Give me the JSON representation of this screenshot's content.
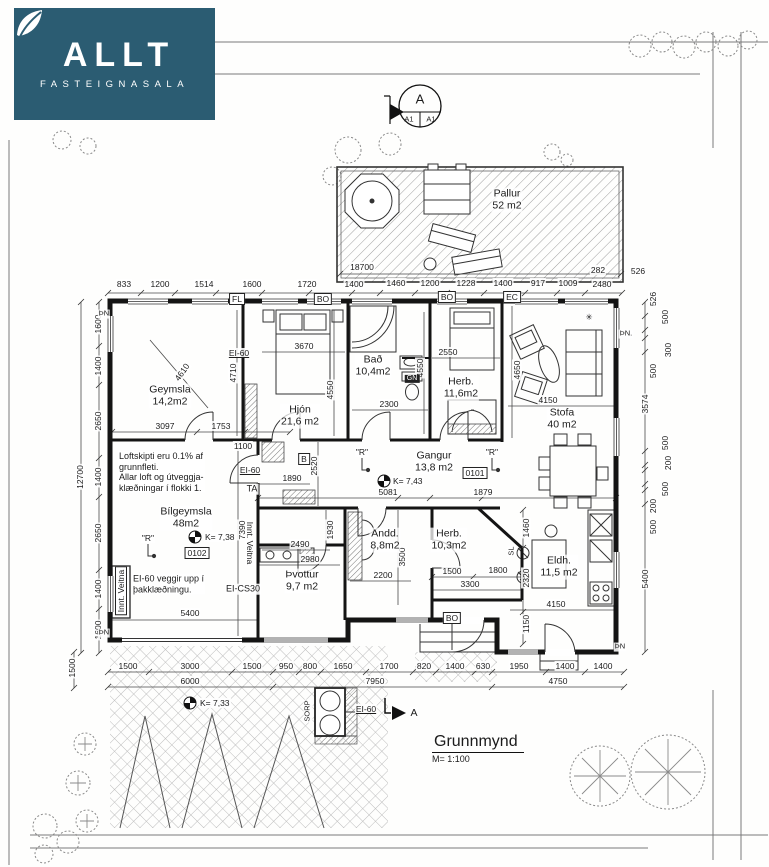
{
  "colors": {
    "logo_bg": "#2b5c72",
    "ink": "#1b1b1b"
  },
  "logo": {
    "brand": "ALLT",
    "subtitle": "FASTEIGNASALA"
  },
  "section_marker": {
    "letter": "A",
    "left": "A1",
    "right": "A1"
  },
  "title_block": {
    "title": "Grunnmynd",
    "scale": "M= 1:100"
  },
  "globes": [
    {
      "x": 384,
      "y": 481
    },
    {
      "x": 195,
      "y": 537
    },
    {
      "x": 190,
      "y": 703
    }
  ],
  "labels": [
    {
      "t": "833",
      "x": 124,
      "y": 284
    },
    {
      "t": "1200",
      "x": 160,
      "y": 284
    },
    {
      "t": "1514",
      "x": 204,
      "y": 284
    },
    {
      "t": "1600",
      "x": 252,
      "y": 284
    },
    {
      "t": "1720",
      "x": 307,
      "y": 284
    },
    {
      "t": "1400",
      "x": 354,
      "y": 284
    },
    {
      "t": "1460",
      "x": 396,
      "y": 283
    },
    {
      "t": "1200",
      "x": 430,
      "y": 283
    },
    {
      "t": "1228",
      "x": 466,
      "y": 283
    },
    {
      "t": "1400",
      "x": 503,
      "y": 283
    },
    {
      "t": "917",
      "x": 538,
      "y": 283
    },
    {
      "t": "1009",
      "x": 568,
      "y": 283
    },
    {
      "t": "282",
      "x": 598,
      "y": 270
    },
    {
      "t": "2480",
      "x": 602,
      "y": 284
    },
    {
      "t": "526",
      "x": 638,
      "y": 271
    },
    {
      "t": "18700",
      "x": 362,
      "y": 267
    },
    {
      "t": "1600",
      "x": 98,
      "y": 324,
      "r": -90
    },
    {
      "t": "1400",
      "x": 98,
      "y": 366,
      "r": -90
    },
    {
      "t": "2650",
      "x": 98,
      "y": 421,
      "r": -90
    },
    {
      "t": "1400",
      "x": 98,
      "y": 477,
      "r": -90
    },
    {
      "t": "2650",
      "x": 98,
      "y": 533,
      "r": -90
    },
    {
      "t": "1400",
      "x": 98,
      "y": 589,
      "r": -90
    },
    {
      "t": "1600",
      "x": 98,
      "y": 630,
      "r": -90
    },
    {
      "t": "12700",
      "x": 80,
      "y": 477,
      "r": -90
    },
    {
      "t": "1500",
      "x": 72,
      "y": 668,
      "r": -90
    },
    {
      "t": "526",
      "x": 653,
      "y": 299,
      "r": -90
    },
    {
      "t": "500",
      "x": 665,
      "y": 317,
      "r": -90
    },
    {
      "t": "300",
      "x": 668,
      "y": 350,
      "r": -90
    },
    {
      "t": "500",
      "x": 653,
      "y": 371,
      "r": -90
    },
    {
      "t": "3574",
      "x": 645,
      "y": 404,
      "r": -90
    },
    {
      "t": "500",
      "x": 665,
      "y": 443,
      "r": -90
    },
    {
      "t": "200",
      "x": 668,
      "y": 463,
      "r": -90
    },
    {
      "t": "500",
      "x": 665,
      "y": 489,
      "r": -90
    },
    {
      "t": "200",
      "x": 653,
      "y": 506,
      "r": -90
    },
    {
      "t": "500",
      "x": 653,
      "y": 527,
      "r": -90
    },
    {
      "t": "5400",
      "x": 645,
      "y": 579,
      "r": -90
    },
    {
      "t": "1500",
      "x": 128,
      "y": 666
    },
    {
      "t": "3000",
      "x": 190,
      "y": 666
    },
    {
      "t": "1500",
      "x": 252,
      "y": 666
    },
    {
      "t": "950",
      "x": 286,
      "y": 666
    },
    {
      "t": "800",
      "x": 310,
      "y": 666
    },
    {
      "t": "1650",
      "x": 343,
      "y": 666
    },
    {
      "t": "1700",
      "x": 389,
      "y": 666
    },
    {
      "t": "820",
      "x": 424,
      "y": 666
    },
    {
      "t": "1400",
      "x": 455,
      "y": 666
    },
    {
      "t": "630",
      "x": 483,
      "y": 666
    },
    {
      "t": "1950",
      "x": 519,
      "y": 666
    },
    {
      "t": "1400",
      "x": 565,
      "y": 666
    },
    {
      "t": "1400",
      "x": 603,
      "y": 666
    },
    {
      "t": "6000",
      "x": 190,
      "y": 681
    },
    {
      "t": "7950",
      "x": 375,
      "y": 681
    },
    {
      "t": "4750",
      "x": 558,
      "y": 681
    },
    {
      "t": "3097",
      "x": 165,
      "y": 426
    },
    {
      "t": "1753",
      "x": 221,
      "y": 426
    },
    {
      "t": "1100",
      "x": 243,
      "y": 446
    },
    {
      "t": "3670",
      "x": 304,
      "y": 346
    },
    {
      "t": "4710",
      "x": 233,
      "y": 373,
      "r": -90
    },
    {
      "t": "4550",
      "x": 330,
      "y": 390,
      "r": -90
    },
    {
      "t": "2550",
      "x": 448,
      "y": 352
    },
    {
      "t": "2300",
      "x": 389,
      "y": 404
    },
    {
      "t": "4550",
      "x": 420,
      "y": 368,
      "r": -90
    },
    {
      "t": "4650",
      "x": 517,
      "y": 370,
      "r": -90
    },
    {
      "t": "4150",
      "x": 548,
      "y": 400
    },
    {
      "t": "1890",
      "x": 292,
      "y": 478
    },
    {
      "t": "2520",
      "x": 314,
      "y": 466,
      "r": -90
    },
    {
      "t": "5081",
      "x": 388,
      "y": 492
    },
    {
      "t": "1879",
      "x": 483,
      "y": 492
    },
    {
      "t": "2490",
      "x": 300,
      "y": 544
    },
    {
      "t": "1930",
      "x": 330,
      "y": 530,
      "r": -90
    },
    {
      "t": "2980",
      "x": 310,
      "y": 559
    },
    {
      "t": "2200",
      "x": 383,
      "y": 575
    },
    {
      "t": "3500",
      "x": 402,
      "y": 557,
      "r": -90
    },
    {
      "t": "1500",
      "x": 452,
      "y": 571
    },
    {
      "t": "1800",
      "x": 498,
      "y": 570
    },
    {
      "t": "3300",
      "x": 470,
      "y": 584
    },
    {
      "t": "5400",
      "x": 190,
      "y": 613
    },
    {
      "t": "7390",
      "x": 242,
      "y": 530,
      "r": -90
    },
    {
      "t": "1460",
      "x": 526,
      "y": 528,
      "r": -90
    },
    {
      "t": "2320",
      "x": 526,
      "y": 578,
      "r": -90
    },
    {
      "t": "1150",
      "x": 526,
      "y": 624,
      "r": -90
    },
    {
      "t": "4150",
      "x": 556,
      "y": 604
    },
    {
      "t": "4610",
      "x": 182,
      "y": 372,
      "r": -55
    },
    {
      "t": "Geymsla\n14,2m2",
      "x": 170,
      "y": 396,
      "s": "room",
      "n": "room-label-geymsla"
    },
    {
      "t": "Hjón\n21,6 m2",
      "x": 300,
      "y": 416,
      "s": "room",
      "n": "room-label-hjon"
    },
    {
      "t": "Bað\n10,4m2",
      "x": 373,
      "y": 366,
      "s": "room",
      "n": "room-label-bad"
    },
    {
      "t": "Herb.\n11,6m2",
      "x": 461,
      "y": 388,
      "s": "room",
      "n": "room-label-herb1"
    },
    {
      "t": "Stofa\n40 m2",
      "x": 562,
      "y": 419,
      "s": "room",
      "n": "room-label-stofa"
    },
    {
      "t": "Gangur\n13,8 m2",
      "x": 434,
      "y": 462,
      "s": "room",
      "n": "room-label-gangur"
    },
    {
      "t": "Bílgeymsla\n48m2",
      "x": 186,
      "y": 518,
      "s": "room",
      "n": "room-label-bilgeymsla"
    },
    {
      "t": "Þvottur\n9,7 m2",
      "x": 302,
      "y": 581,
      "s": "room",
      "n": "room-label-thvottur"
    },
    {
      "t": "Andd.\n8,8m2",
      "x": 385,
      "y": 540,
      "s": "room",
      "n": "room-label-andd"
    },
    {
      "t": "Herb.\n10,3m2",
      "x": 449,
      "y": 540,
      "s": "room",
      "n": "room-label-herb2"
    },
    {
      "t": "Eldh.\n11,5 m2",
      "x": 559,
      "y": 567,
      "s": "room",
      "n": "room-label-eldhus"
    },
    {
      "t": "Pallur\n52 m2",
      "x": 507,
      "y": 200,
      "s": "room",
      "n": "room-label-pallur"
    },
    {
      "t": "Loftskipti eru 0.1% af\ngrunnfleti.\nAllar loft og útveggja-\nklæðningar í flokki 1.",
      "x": 118,
      "y": 472,
      "s": "note",
      "a": "l",
      "n": "note-ventilation"
    },
    {
      "t": "EI-60 veggir upp í\nþakklæðningu.",
      "x": 132,
      "y": 584,
      "s": "note",
      "a": "l",
      "n": "note-fire-wall"
    },
    {
      "t": "EI-60",
      "x": 239,
      "y": 353,
      "u": 1,
      "n": "tag-ei60"
    },
    {
      "t": "EI-60",
      "x": 250,
      "y": 470,
      "u": 1,
      "n": "tag-ei60"
    },
    {
      "t": "TA",
      "x": 252,
      "y": 489,
      "s": "note",
      "n": "tag-ta"
    },
    {
      "t": "EI-CS30",
      "x": 243,
      "y": 589,
      "s": "note",
      "n": "tag-ei-cs30"
    },
    {
      "t": "EI-60",
      "x": 366,
      "y": 709,
      "u": 1,
      "n": "tag-ei60"
    },
    {
      "t": "0101",
      "x": 475,
      "y": 473,
      "b": 1,
      "n": "tag-room-0101"
    },
    {
      "t": "0102",
      "x": 197,
      "y": 553,
      "b": 1,
      "n": "tag-room-0102"
    },
    {
      "t": "FL",
      "x": 237,
      "y": 299,
      "b": 1,
      "n": "tag-fl"
    },
    {
      "t": "BO",
      "x": 323,
      "y": 299,
      "b": 1,
      "n": "tag-bo"
    },
    {
      "t": "BO",
      "x": 447,
      "y": 297,
      "b": 1,
      "n": "tag-bo"
    },
    {
      "t": "EC",
      "x": 512,
      "y": 297,
      "b": 1,
      "n": "tag-ec"
    },
    {
      "t": "BO",
      "x": 452,
      "y": 618,
      "b": 1,
      "n": "tag-bo"
    },
    {
      "t": "B",
      "x": 304,
      "y": 459,
      "b": 1,
      "n": "tag-b"
    },
    {
      "t": "GN",
      "x": 412,
      "y": 379,
      "inv": 1,
      "n": "tag-gn"
    },
    {
      "t": "\"R\"",
      "x": 362,
      "y": 452,
      "n": "sprinkler-marker"
    },
    {
      "t": "\"R\"",
      "x": 492,
      "y": 452,
      "n": "sprinkler-marker"
    },
    {
      "t": "\"R\"",
      "x": 148,
      "y": 538,
      "n": "sprinkler-marker"
    },
    {
      "t": "K= 7,43",
      "x": 392,
      "y": 481,
      "a": "l",
      "n": "level-marker-label"
    },
    {
      "t": "K= 7,38",
      "x": 204,
      "y": 537,
      "a": "l",
      "n": "level-marker-label"
    },
    {
      "t": "K= 7,33",
      "x": 199,
      "y": 703,
      "a": "l",
      "n": "level-marker-label"
    },
    {
      "t": "Innt. Veitna",
      "x": 121,
      "y": 591,
      "r": -90,
      "b": 1,
      "n": "tag-innt-veitna"
    },
    {
      "t": "Innt. Veitna",
      "x": 250,
      "y": 543,
      "r": 90,
      "n": "tag-innt-veitna"
    },
    {
      "t": "SL",
      "x": 512,
      "y": 551,
      "r": -90,
      "s": "tiny",
      "n": "tag-sl"
    },
    {
      "t": "ÞN",
      "x": 104,
      "y": 314,
      "s": "tiny",
      "n": "corner-marker"
    },
    {
      "t": "ÞN",
      "x": 104,
      "y": 633,
      "s": "tiny",
      "n": "corner-marker"
    },
    {
      "t": "ÞN.",
      "x": 626,
      "y": 334,
      "s": "tiny",
      "n": "corner-marker"
    },
    {
      "t": "ÞN",
      "x": 620,
      "y": 647,
      "s": "tiny",
      "n": "corner-marker"
    },
    {
      "t": "SORP",
      "x": 308,
      "y": 711,
      "r": -90,
      "s": "tiny",
      "n": "tag-sorp"
    },
    {
      "t": "A",
      "x": 414,
      "y": 713,
      "s": "room",
      "n": "section-arrow-label"
    },
    {
      "t": "✳",
      "x": 589,
      "y": 317,
      "n": "plant-icon"
    }
  ]
}
